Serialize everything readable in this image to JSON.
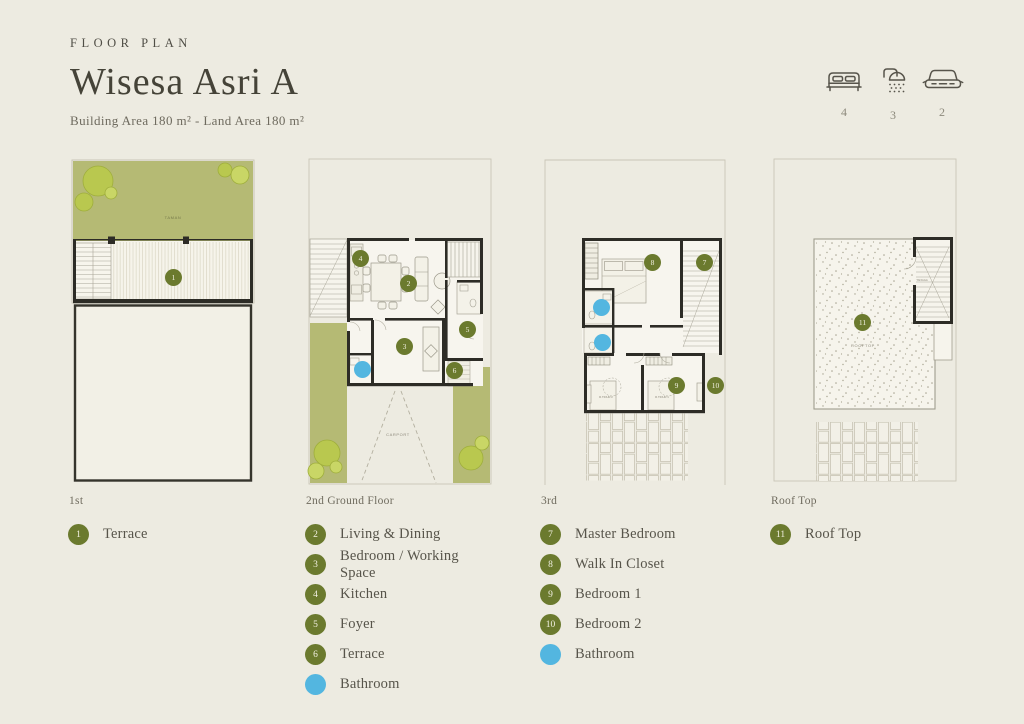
{
  "header": {
    "eyebrow": "FLOOR PLAN",
    "title": "Wisesa Asri A",
    "subtitle": "Building Area 180 m² - Land Area 180 m²"
  },
  "stats": {
    "items": [
      {
        "icon": "bed-icon",
        "value": "4"
      },
      {
        "icon": "shower-icon",
        "value": "3"
      },
      {
        "icon": "car-icon",
        "value": "2"
      }
    ]
  },
  "colors": {
    "accent_olive": "#6b7a2e",
    "accent_blue": "#53b6e0",
    "garden_green": "#b5ba74",
    "background": "#edebe1"
  },
  "columns": [
    {
      "caption": "1st",
      "plan_labels": {
        "garden": "TAMAN"
      },
      "markers": [
        {
          "n": "1",
          "type": "green"
        }
      ],
      "legend": [
        {
          "n": "1",
          "label": "Terrace",
          "type": "green"
        }
      ]
    },
    {
      "caption": "2nd Ground Floor",
      "plan_labels": {
        "carport": "CARPORT"
      },
      "markers": [
        {
          "n": "4",
          "type": "green"
        },
        {
          "n": "2",
          "type": "green"
        },
        {
          "n": "5",
          "type": "green"
        },
        {
          "n": "3",
          "type": "green"
        },
        {
          "n": "6",
          "type": "green"
        },
        {
          "n": "",
          "type": "blue"
        }
      ],
      "legend": [
        {
          "n": "2",
          "label": "Living & Dining",
          "type": "green"
        },
        {
          "n": "3",
          "label": "Bedroom / Working Space",
          "type": "green"
        },
        {
          "n": "4",
          "label": "Kitchen",
          "type": "green"
        },
        {
          "n": "5",
          "label": "Foyer",
          "type": "green"
        },
        {
          "n": "6",
          "label": "Terrace",
          "type": "green"
        },
        {
          "n": "",
          "label": "Bathroom",
          "type": "blue"
        }
      ]
    },
    {
      "caption": "3rd",
      "plan_labels": {
        "bedroom1": "R.TIDUR 1",
        "bedroom2": "R.TIDUR 2"
      },
      "markers": [
        {
          "n": "8",
          "type": "green"
        },
        {
          "n": "7",
          "type": "green"
        },
        {
          "n": "",
          "type": "blue"
        },
        {
          "n": "",
          "type": "blue"
        },
        {
          "n": "9",
          "type": "green"
        },
        {
          "n": "10",
          "type": "green"
        }
      ],
      "legend": [
        {
          "n": "7",
          "label": "Master Bedroom",
          "type": "green"
        },
        {
          "n": "8",
          "label": "Walk In Closet",
          "type": "green"
        },
        {
          "n": "9",
          "label": "Bedroom 1",
          "type": "green"
        },
        {
          "n": "10",
          "label": "Bedroom 2",
          "type": "green"
        },
        {
          "n": "",
          "label": "Bathroom",
          "type": "blue"
        }
      ]
    },
    {
      "caption": "Roof Top",
      "plan_labels": {
        "rooftop": "ROOFTOP",
        "stairs": "TANGGA"
      },
      "markers": [
        {
          "n": "11",
          "type": "green"
        }
      ],
      "legend": [
        {
          "n": "11",
          "label": "Roof Top",
          "type": "green"
        }
      ]
    }
  ]
}
